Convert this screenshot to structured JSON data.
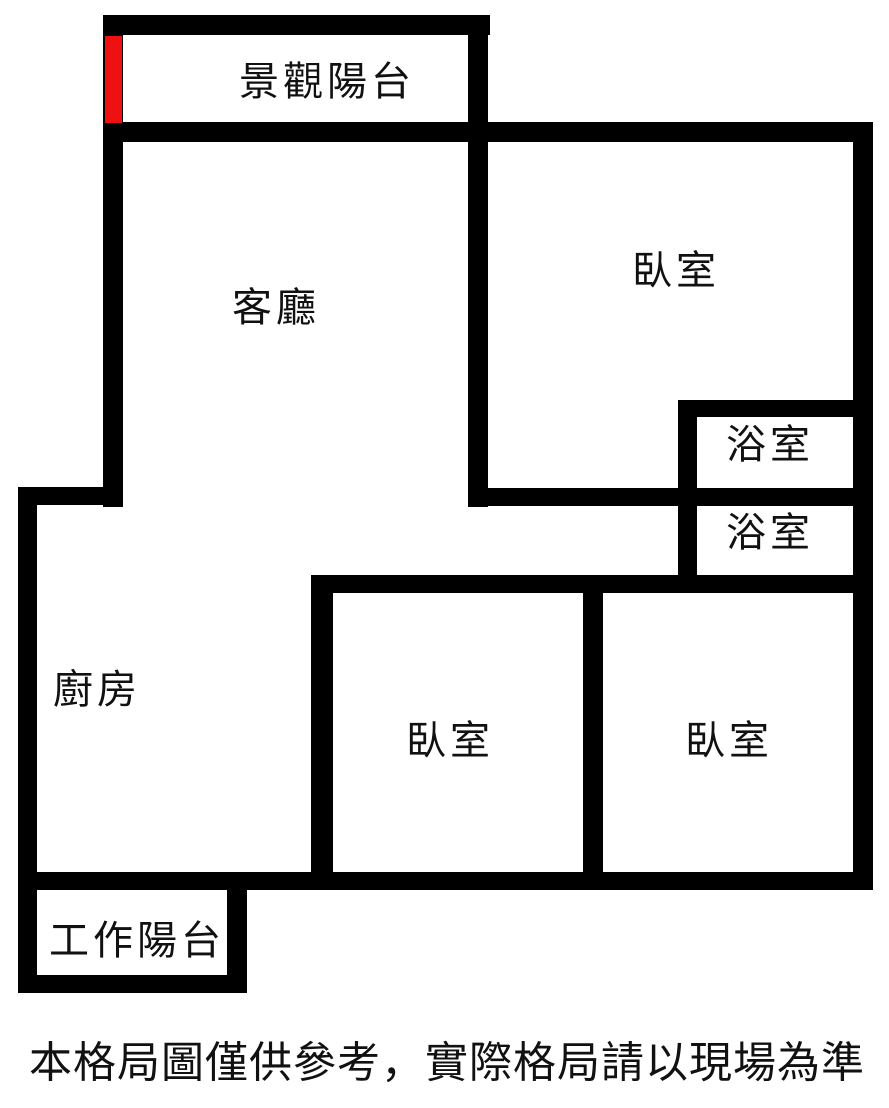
{
  "floor_plan": {
    "rooms": [
      {
        "id": "scenic-balcony",
        "label": "景觀陽台"
      },
      {
        "id": "living-room",
        "label": "客廳"
      },
      {
        "id": "bedroom-top",
        "label": "臥室"
      },
      {
        "id": "bathroom-upper",
        "label": "浴室"
      },
      {
        "id": "bathroom-lower",
        "label": "浴室"
      },
      {
        "id": "kitchen",
        "label": "廚房"
      },
      {
        "id": "bedroom-middle",
        "label": "臥室"
      },
      {
        "id": "bedroom-right",
        "label": "臥室"
      },
      {
        "id": "work-balcony",
        "label": "工作陽台"
      }
    ],
    "disclaimer": "本格局圖僅供參考，實際格局請以現場為準",
    "colors": {
      "wall": "#000000",
      "background": "#ffffff",
      "entrance_marker": "#ee1111"
    }
  }
}
